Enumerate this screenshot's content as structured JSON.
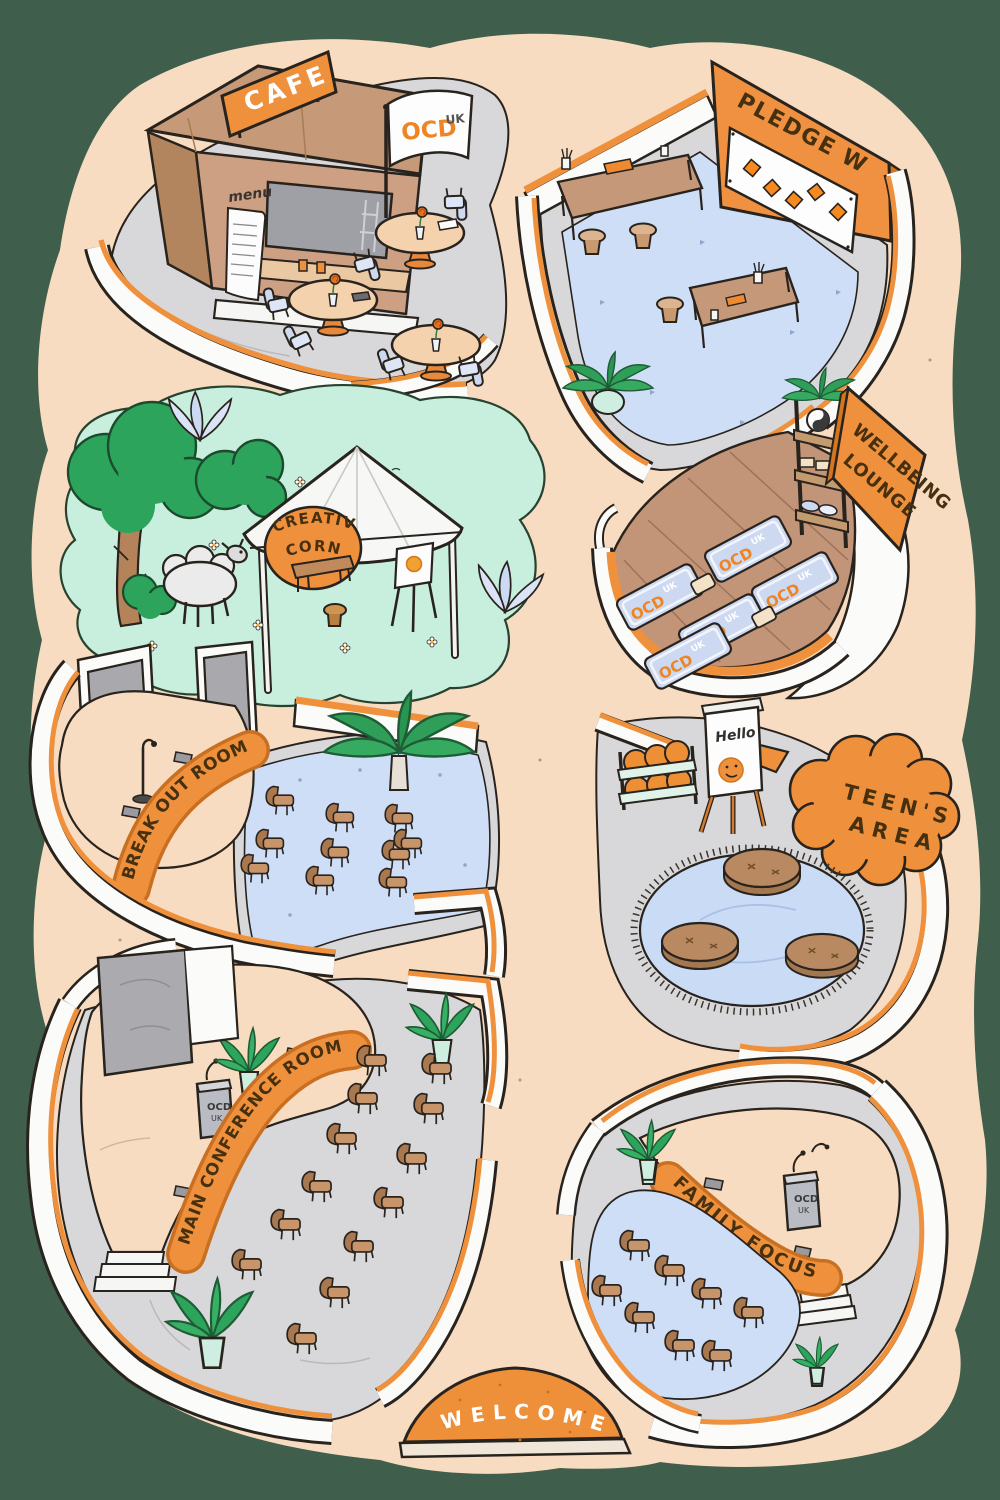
{
  "illustration": {
    "kind": "isometric-venue-map",
    "background_color": "#3f5e4b",
    "ground_color": "#f8dcc2",
    "accent_color": "#ef913c"
  },
  "brand": {
    "name": "OCD",
    "suffix": "UK"
  },
  "rooms": {
    "cafe": {
      "label": "CAFE",
      "menu_label": "menu"
    },
    "pledge_wall": {
      "label": "PLEDGE WALL"
    },
    "creative_corner": {
      "label_line1": "CREATIVE",
      "label_line2": "CORNER"
    },
    "wellbeing_lounge": {
      "label_line1": "WELLBEING",
      "label_line2": "LOUNGE"
    },
    "break_out_room": {
      "label": "BREAK OUT ROOM"
    },
    "teens_area": {
      "label_line1": "TEEN'S",
      "label_line2": "AREA",
      "flipchart_text": "Hello"
    },
    "main_conference_room": {
      "label": "MAIN CONFERENCE ROOM"
    },
    "family_focus": {
      "label": "FAMILY FOCUS"
    },
    "welcome": {
      "label": "WELCOME"
    }
  },
  "colors": {
    "background_green": "#3f5e4b",
    "peach_ground": "#f8dcc2",
    "accent_orange": "#ef913c",
    "deep_orange": "#c96f22",
    "lawn_green": "#c8efdd",
    "tree_green": "#2ca45c",
    "carpet_blue": "#cfdef7",
    "floor_gray": "#d8d8da",
    "wood_brown": "#c59879",
    "kiosk_brown": "#cda084",
    "outline_ink": "#29231e"
  }
}
